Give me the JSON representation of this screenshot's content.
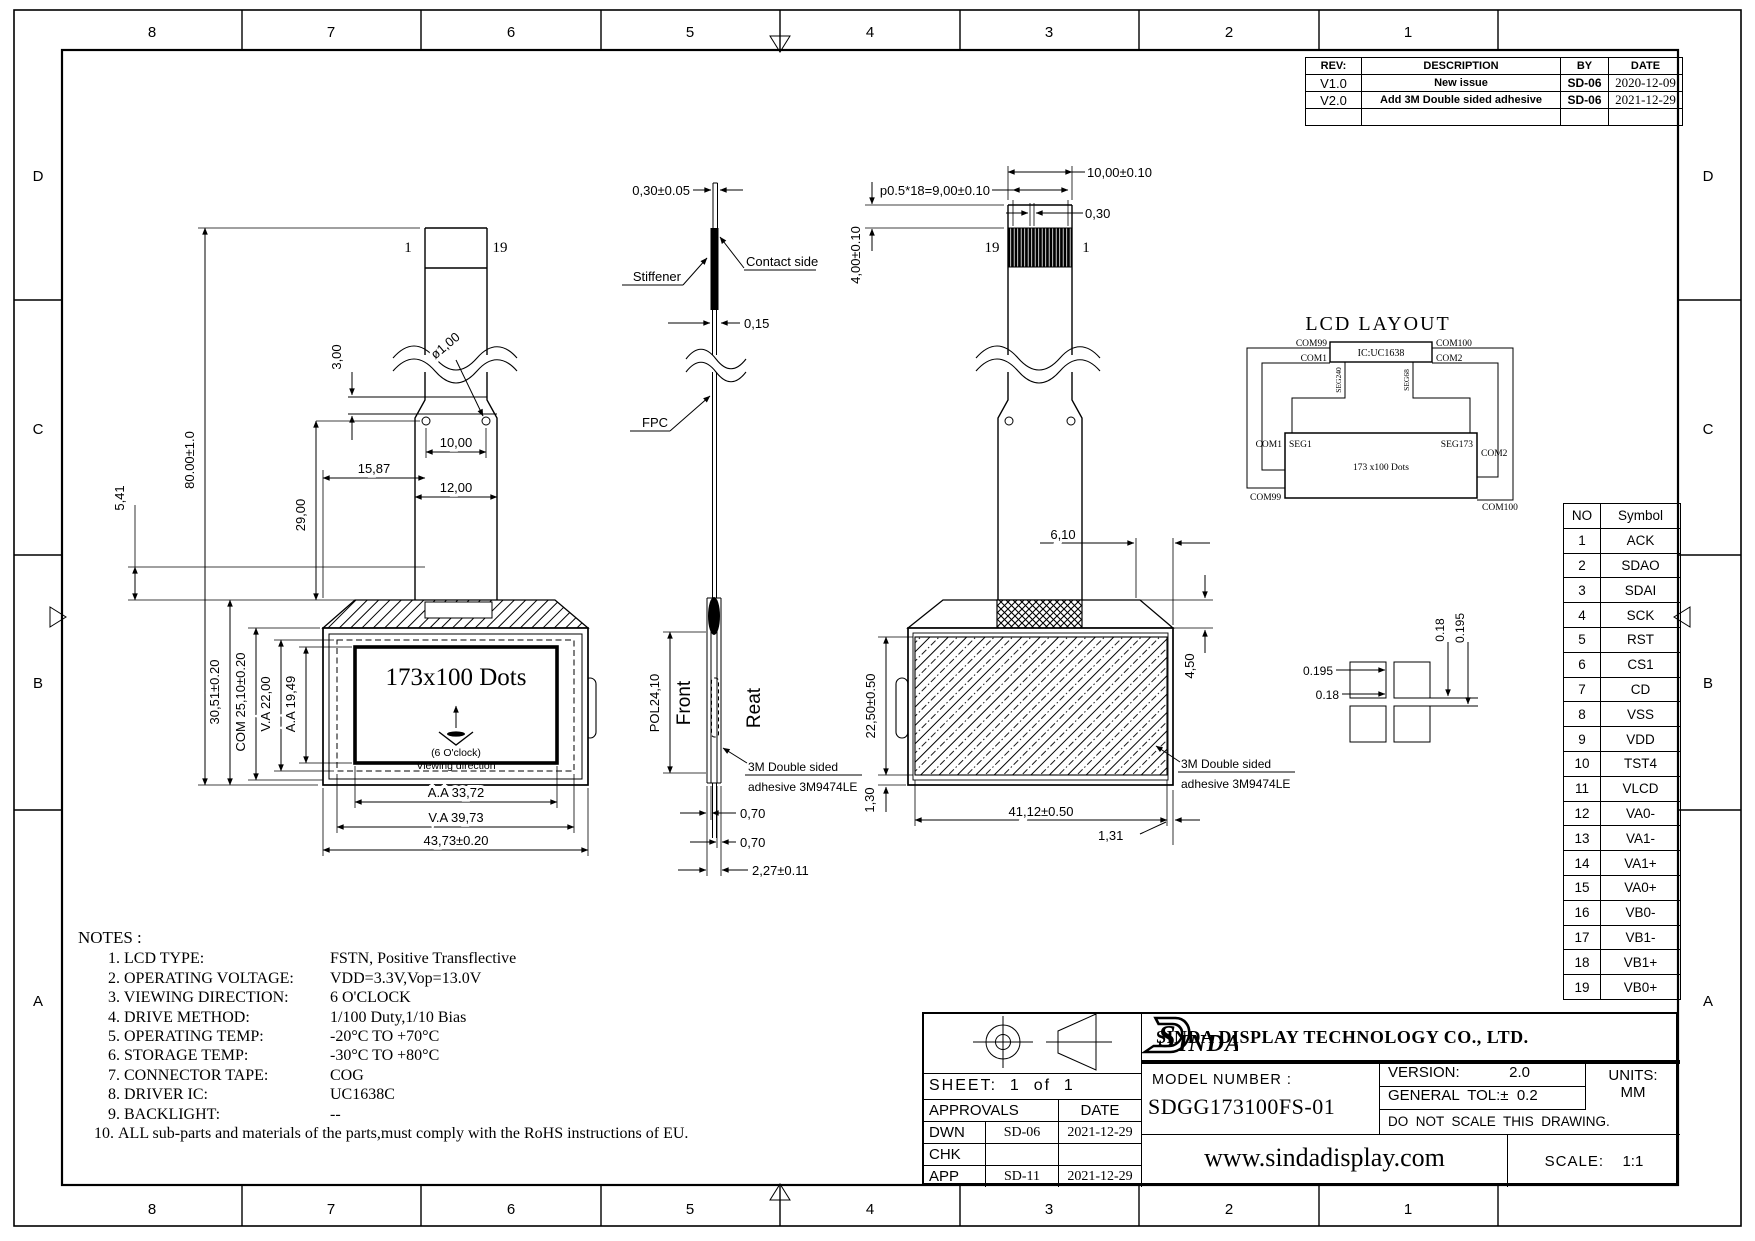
{
  "zones": {
    "cols": [
      "8",
      "7",
      "6",
      "5",
      "4",
      "3",
      "2",
      "1"
    ],
    "rows": [
      "D",
      "C",
      "B",
      "A"
    ]
  },
  "rev_table": {
    "headers": {
      "rev": "REV:",
      "description": "DESCRIPTION",
      "by": "BY",
      "date": "DATE"
    },
    "rows": [
      {
        "rev": "V1.0",
        "description": "New  issue",
        "by": "SD-06",
        "date": "2020-12-09"
      },
      {
        "rev": "V2.0",
        "description": "Add  3M  Double  sided  adhesive",
        "by": "SD-06",
        "date": "2021-12-29"
      }
    ]
  },
  "front_view": {
    "pin_left": "1",
    "pin_right": "19",
    "dim_total": "80.00±1.0",
    "dim_fold": "3,00",
    "dim_hole": "ø1,00",
    "dim_hole_pitch": "10,00",
    "dim_tail_width": "12,00",
    "dim_tail_offset": "15,87",
    "dim_tail_length": "29,00",
    "dim_top": "5,41",
    "dim_height": "30,51±0.20",
    "dim_com": "COM 25,10±0.20",
    "dim_va_v": "V.A 22,00",
    "dim_aa_v": "A.A 19,49",
    "display_text": "173x100 Dots",
    "clock": "(6 O'clock)",
    "viewing": "Viewing direction",
    "dim_aa_h": "A.A  33,72",
    "dim_va_h": "V.A  39,73",
    "dim_width": "43,73±0.20"
  },
  "side_view": {
    "dim_tip": "0,30±0.05",
    "stiffener": "Stiffener",
    "contact": "Contact side",
    "dim_fpc": "0,15",
    "fpc": "FPC",
    "dim_pol": "POL24,10",
    "front": "Front",
    "rear": "Reat",
    "adh1": "3M Double sided",
    "adh2": "adhesive  3M9474LE",
    "dim_front": "0,70",
    "dim_back": "0,70",
    "dim_total": "2,27±0.11"
  },
  "back_view": {
    "dim_pitch": "p0.5*18=9,00±0.10",
    "dim_width_top": "10,00±0.10",
    "dim_pad": "0,30",
    "dim_bare": "4,00±0.10",
    "pin_left": "19",
    "pin_right": "1",
    "dim_gap": "6,10",
    "dim_corner": "4,50",
    "dim_adh_h": "22,50±0.50",
    "dim_edge": "1,30",
    "dim_adh_w": "41,12±0.50",
    "dim_edge_r": "1,31",
    "adh1": "3M Double sided",
    "adh2": "adhesive  3M9474LE"
  },
  "lcd_layout": {
    "title": "LCD  LAYOUT",
    "ic": "IC:UC1638",
    "com99": "COM99",
    "com1": "COM1",
    "com100": "COM100",
    "com2": "COM2",
    "seg240": "SEG240",
    "seg68": "SEG68",
    "com1b": "COM1",
    "seg1": "SEG1",
    "seg173": "SEG173",
    "com2b": "COM2",
    "dots": "173 x100 Dots",
    "com99b": "COM99",
    "com100b": "COM100"
  },
  "pad_detail": {
    "d1": "0.195",
    "d2": "0.18",
    "d3": "0.18",
    "d4": "0.195"
  },
  "pin_table": {
    "headers": {
      "no": "NO",
      "symbol": "Symbol"
    },
    "rows": [
      {
        "no": "1",
        "symbol": "ACK"
      },
      {
        "no": "2",
        "symbol": "SDAO"
      },
      {
        "no": "3",
        "symbol": "SDAI"
      },
      {
        "no": "4",
        "symbol": "SCK"
      },
      {
        "no": "5",
        "symbol": "RST"
      },
      {
        "no": "6",
        "symbol": "CS1"
      },
      {
        "no": "7",
        "symbol": "CD"
      },
      {
        "no": "8",
        "symbol": "VSS"
      },
      {
        "no": "9",
        "symbol": "VDD"
      },
      {
        "no": "10",
        "symbol": "TST4"
      },
      {
        "no": "11",
        "symbol": "VLCD"
      },
      {
        "no": "12",
        "symbol": "VA0-"
      },
      {
        "no": "13",
        "symbol": "VA1-"
      },
      {
        "no": "14",
        "symbol": "VA1+"
      },
      {
        "no": "15",
        "symbol": "VA0+"
      },
      {
        "no": "16",
        "symbol": "VB0-"
      },
      {
        "no": "17",
        "symbol": "VB1-"
      },
      {
        "no": "18",
        "symbol": "VB1+"
      },
      {
        "no": "19",
        "symbol": "VB0+"
      }
    ]
  },
  "notes": {
    "title": "NOTES :",
    "items": [
      {
        "label": "1. LCD TYPE:",
        "value": "FSTN, Positive Transflective"
      },
      {
        "label": "2. OPERATING VOLTAGE:",
        "value": "VDD=3.3V,Vop=13.0V"
      },
      {
        "label": "3. VIEWING DIRECTION:",
        "value": "6 O'CLOCK"
      },
      {
        "label": "4. DRIVE METHOD:",
        "value": "1/100 Duty,1/10 Bias"
      },
      {
        "label": "5. OPERATING TEMP:",
        "value": "-20°C TO +70°C"
      },
      {
        "label": "6. STORAGE TEMP:",
        "value": "-30°C TO +80°C"
      },
      {
        "label": "7. CONNECTOR TAPE:",
        "value": "COG"
      },
      {
        "label": "8. DRIVER IC:",
        "value": "UC1638C"
      },
      {
        "label": "9. BACKLIGHT:",
        "value": "--"
      }
    ],
    "note10_num": "10.",
    "note10_text": "ALL sub-parts and materials of the parts,must comply with the RoHS instructions of EU."
  },
  "title_block": {
    "sheet": "SHEET:  1  of  1",
    "approvals": "APPROVALS",
    "date_h": "DATE",
    "rows": [
      {
        "role": "DWN",
        "by": "SD-06",
        "date": "2021-12-29"
      },
      {
        "role": "CHK",
        "by": "",
        "date": ""
      },
      {
        "role": "APP",
        "by": "SD-11",
        "date": "2021-12-29"
      }
    ],
    "logo_s": "S",
    "logo_rest": "INDA",
    "company": "SINDA DISPLAY  TECHNOLOGY  CO., LTD.",
    "model_label": "MODEL  NUMBER  :",
    "model": "SDGG173100FS-01",
    "version_label": "VERSION:",
    "version": "2.0",
    "tol": "GENERAL  TOL:±  0.2",
    "units_label": "UNITS:",
    "units": "MM",
    "no_scale": "DO  NOT  SCALE  THIS  DRAWING.",
    "website": "www.sindadisplay.com",
    "scale_label": "SCALE:",
    "scale": "1:1"
  }
}
